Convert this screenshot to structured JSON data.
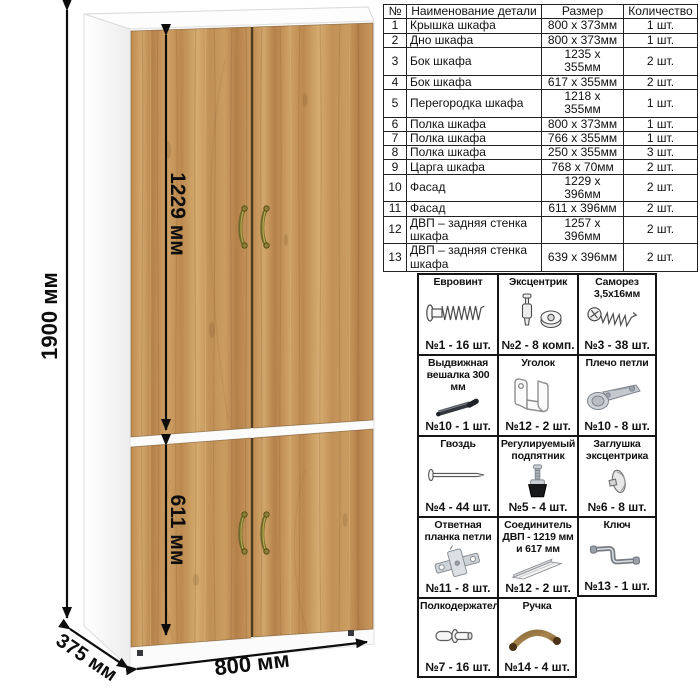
{
  "dims": {
    "height": "1900 мм",
    "facade_upper": "1229 мм",
    "facade_lower": "611 мм",
    "width": "800 мм",
    "depth": "375 мм"
  },
  "parts_table": {
    "headers": [
      "№",
      "Наименование детали",
      "Размер",
      "Количество"
    ],
    "rows": [
      {
        "num": "1",
        "name": "Крышка шкафа",
        "size": "800 х 373мм",
        "qty": "1 шт."
      },
      {
        "num": "2",
        "name": "Дно шкафа",
        "size": "800 х 373мм",
        "qty": "1 шт."
      },
      {
        "num": "3",
        "name": "Бок шкафа",
        "size": "1235 х 355мм",
        "qty": "2 шт."
      },
      {
        "num": "4",
        "name": "Бок шкафа",
        "size": "617 х 355мм",
        "qty": "2 шт."
      },
      {
        "num": "5",
        "name": "Перегородка шкафа",
        "size": "1218 х 355мм",
        "qty": "1 шт."
      },
      {
        "num": "6",
        "name": "Полка шкафа",
        "size": "800 х 373мм",
        "qty": "1 шт."
      },
      {
        "num": "7",
        "name": "Полка шкафа",
        "size": "766 х 355мм",
        "qty": "1 шт."
      },
      {
        "num": "8",
        "name": "Полка шкафа",
        "size": "250 х 355мм",
        "qty": "3 шт."
      },
      {
        "num": "9",
        "name": "Царга шкафа",
        "size": "768 х 70мм",
        "qty": "2 шт."
      },
      {
        "num": "10",
        "name": "Фасад",
        "size": "1229 х 396мм",
        "qty": "2 шт."
      },
      {
        "num": "11",
        "name": "Фасад",
        "size": "611 х 396мм",
        "qty": "2 шт."
      },
      {
        "num": "12",
        "name": "ДВП – задняя стенка шкафа",
        "size": "1257 х 396мм",
        "qty": "2 шт."
      },
      {
        "num": "13",
        "name": "ДВП – задняя стенка шкафа",
        "size": "639 х 396мм",
        "qty": "2 шт."
      }
    ]
  },
  "hardware": {
    "items": [
      {
        "title": "Евровинт",
        "icon": "euro-screw-icon",
        "count": "№1 - 16 шт."
      },
      {
        "title": "Эксцентрик",
        "icon": "cam-lock-icon",
        "count": "№2 - 8 комп."
      },
      {
        "title": "Саморез 3,5х16мм",
        "icon": "self-tapping-screw-icon",
        "count": "№3 - 38 шт."
      },
      {
        "title": "Выдвижная вешалка 300 мм",
        "icon": "pullout-hanger-icon",
        "count": "№10 - 1 шт."
      },
      {
        "title": "Уголок",
        "icon": "corner-bracket-icon",
        "count": "№12 - 2 шт."
      },
      {
        "title": "Плечо петли",
        "icon": "hinge-arm-icon",
        "count": "№10 - 8 шт."
      },
      {
        "title": "Гвоздь",
        "icon": "nail-icon",
        "count": "№4 - 44 шт."
      },
      {
        "title": "Регулируемый подпятник",
        "icon": "adjustable-foot-icon",
        "count": "№5 - 4 шт."
      },
      {
        "title": "Заглушка эксцентрика",
        "icon": "cam-cap-icon",
        "count": "№6 - 8 шт."
      },
      {
        "title": "Ответная планка петли",
        "icon": "hinge-plate-icon",
        "count": "№11 - 8 шт."
      },
      {
        "title": "Соединитель ДВП - 1219 мм и 617 мм",
        "icon": "hdf-connector-icon",
        "count": "№12 - 2 шт."
      },
      {
        "title": "Ключ",
        "icon": "hex-key-icon",
        "count": "№13 - 1 шт."
      },
      {
        "title": "Полкодержатель",
        "icon": "shelf-pin-icon",
        "count": "№7 - 16 шт."
      },
      {
        "title": "Ручка",
        "icon": "handle-icon",
        "count": "№14 - 4 шт."
      }
    ]
  },
  "colors": {
    "wood_mid": "#c2915a",
    "wood_dark": "#a97c45",
    "wood_light": "#d7ad72",
    "handle_bronze": "#8a7f33",
    "line": "#111111"
  }
}
